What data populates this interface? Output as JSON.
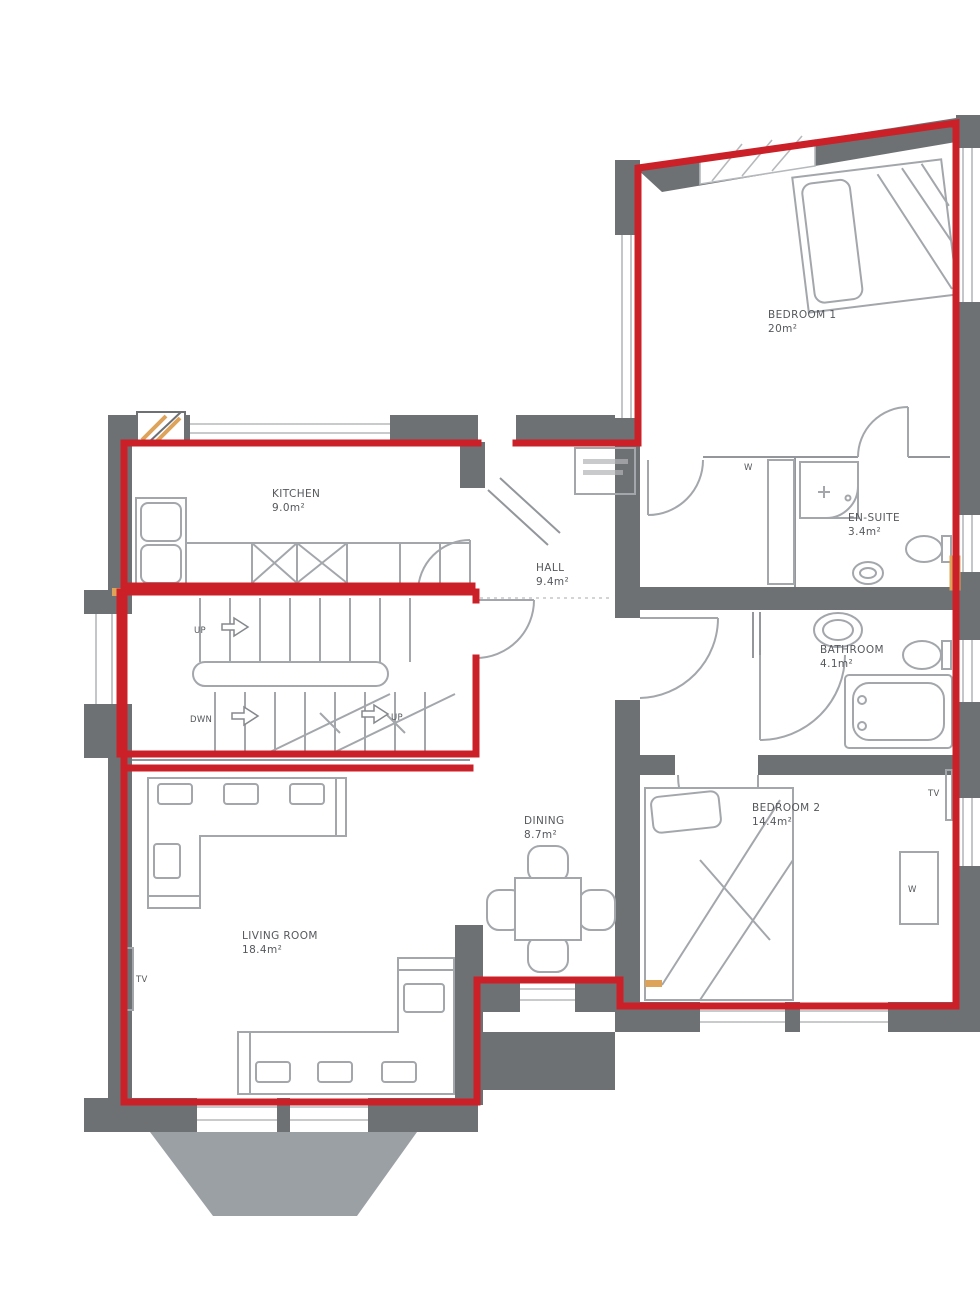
{
  "plan": {
    "rooms": {
      "bedroom1": {
        "name": "BEDROOM 1",
        "area": "20m²"
      },
      "ensuite": {
        "name": "EN-SUITE",
        "area": "3.4m²"
      },
      "bathroom": {
        "name": "BATHROOM",
        "area": "4.1m²"
      },
      "bedroom2": {
        "name": "BEDROOM 2",
        "area": "14.4m²"
      },
      "kitchen": {
        "name": "KITCHEN",
        "area": "9.0m²"
      },
      "hall": {
        "name": "HALL",
        "area": "9.4m²"
      },
      "dining": {
        "name": "DINING",
        "area": "8.7m²"
      },
      "living": {
        "name": "LIVING ROOM",
        "area": "18.4m²"
      }
    },
    "stairs": {
      "up_label": "UP",
      "down_label": "DWN",
      "up_label_2": "UP"
    },
    "labels": {
      "tv_living": "TV",
      "tv_bedroom2": "TV",
      "wardrobe_bedroom1": "W",
      "wardrobe_bedroom2": "W"
    },
    "colors": {
      "wall_gray": "#6e7174",
      "bay_gray": "#9ba0a4",
      "boundary_red": "#cb2027",
      "furniture_gray": "#a3a7ab",
      "label_gray": "#55585c",
      "accent_orange": "#dda35b"
    }
  }
}
